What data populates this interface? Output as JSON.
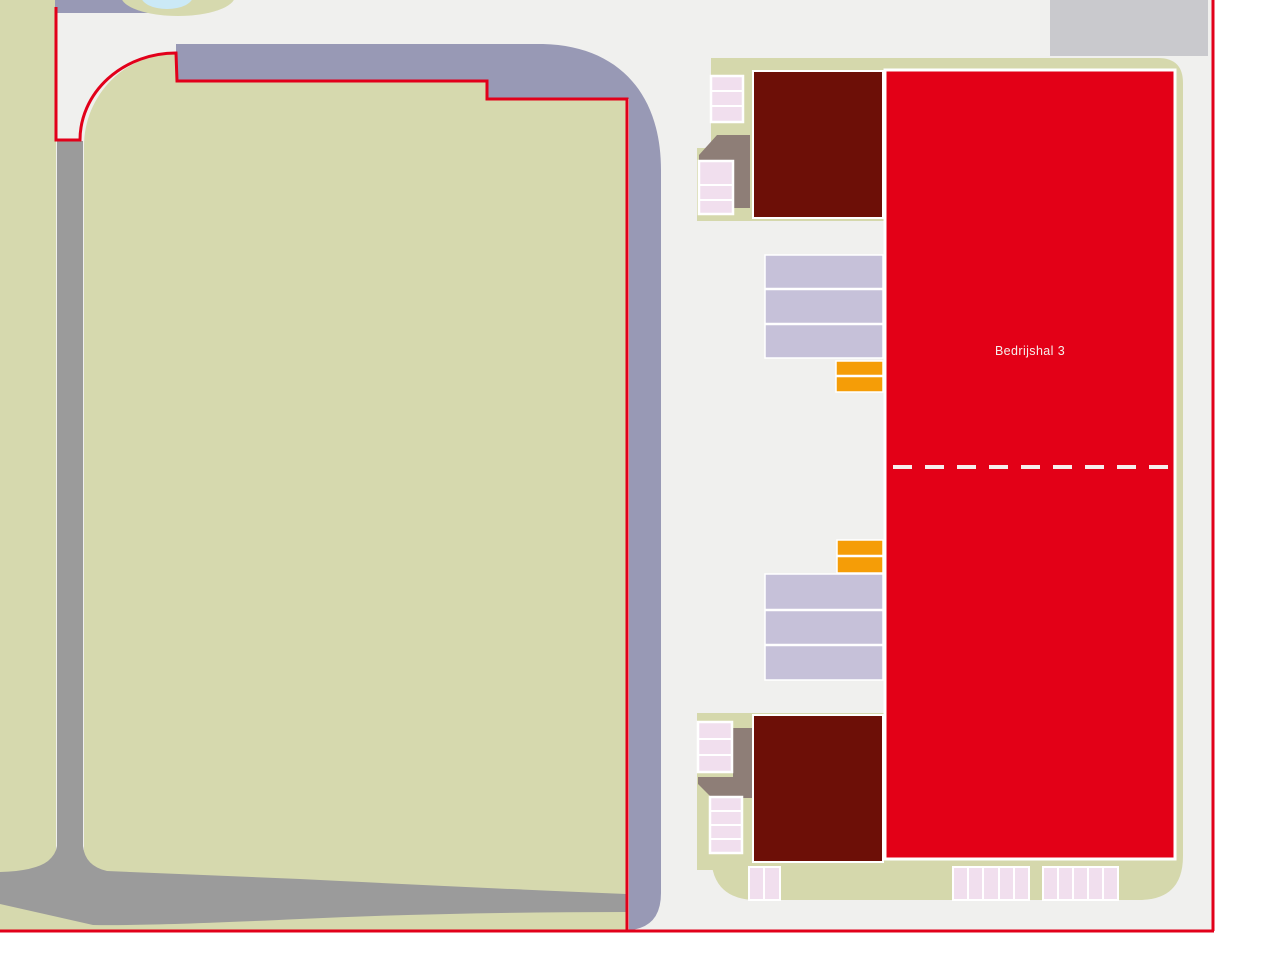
{
  "map": {
    "building_label": "Bedrijshal 3",
    "site": {
      "plot_boundary": "red outline",
      "highlighted_building": "Bedrijshal 3",
      "secondary_buildings": 2,
      "lavender_row_blocks": [
        3,
        3
      ],
      "orange_row_blocks": [
        2,
        2
      ],
      "parking_groups": {
        "upper_left_a_cells": 3,
        "upper_left_b_cells": 3,
        "lower_left_c_cells": 3,
        "lower_left_d_cells": 4,
        "bottom_small_cells": 2,
        "bottom_mid_cells": 5,
        "bottom_right_cells": 5
      }
    }
  },
  "colors": {
    "outside_white": "#ffffff",
    "background_gray": "#f0f0ee",
    "field_green": "#d6d9ae",
    "pad_green": "#d5d8ac",
    "band_purple": "#9899b5",
    "strip_purple": "#9899b5",
    "road_gray": "#9b9b9b",
    "block_gray": "#c9c9cd",
    "pond_blue": "#cbe9f6",
    "boundary_red": "#e2001a",
    "hall_red": "#e30017",
    "building_maroon": "#6d0f07",
    "lavender": "#c6c1d9",
    "orange": "#f59d07",
    "parking_pink": "#f1dfee",
    "taupe": "#8e7e77",
    "divider_white": "#ffffff",
    "dash_white": "#f6eeec",
    "label_white": "#f6eeec"
  }
}
